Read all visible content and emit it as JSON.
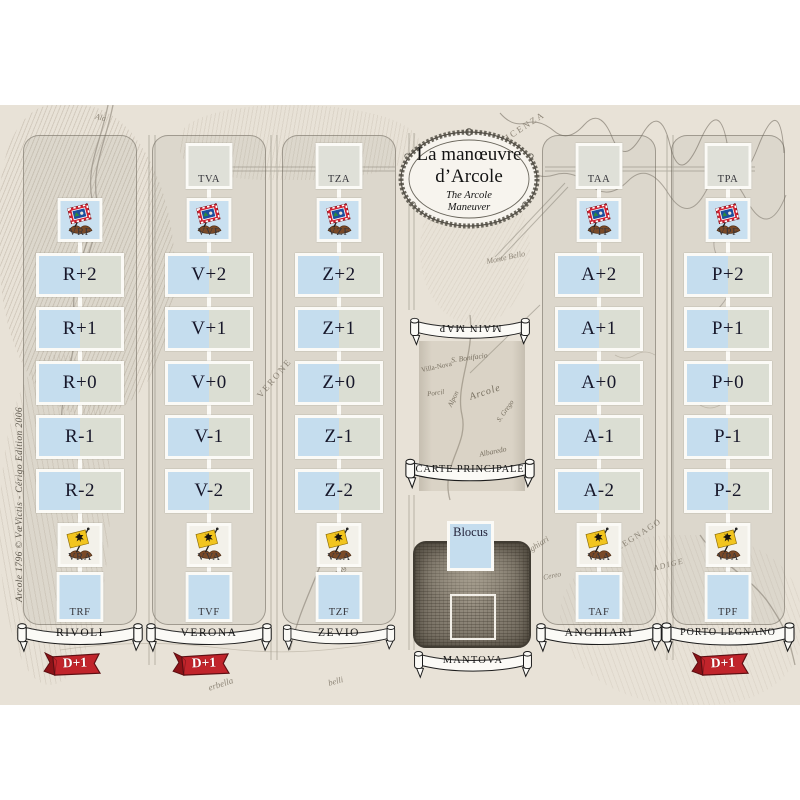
{
  "credit": "Arcole 1796 © VæVictis - Cérigo Edition 2006",
  "title": {
    "line1": "La manœuvre",
    "line2": "d’Arcole",
    "sub1": "The Arcole",
    "sub2": "Maneuver"
  },
  "center": {
    "main_map": "MAIN MAP",
    "carte_principale": "CARTE PRINCIPALE",
    "blocus": "Blocus",
    "city": "MANTOVA"
  },
  "columns": [
    {
      "city": "RIVOLI",
      "top": "",
      "french_flag": "VRF",
      "slots": [
        "R+2",
        "R+1",
        "R+0",
        "R-1",
        "R-2"
      ],
      "austrian_flag": "VRA",
      "bottom": "TRF",
      "bonus": "D+1"
    },
    {
      "city": "VERONA",
      "top": "TVA",
      "french_flag": "VVF",
      "slots": [
        "V+2",
        "V+1",
        "V+0",
        "V-1",
        "V-2"
      ],
      "austrian_flag": "VVA",
      "bottom": "TVF",
      "bonus": "D+1"
    },
    {
      "city": "ZEVIO",
      "top": "TZA",
      "french_flag": "VZF",
      "slots": [
        "Z+2",
        "Z+1",
        "Z+0",
        "Z-1",
        "Z-2"
      ],
      "austrian_flag": "VZA",
      "bottom": "TZF",
      "bonus": ""
    },
    {
      "city": "ANGHIARI",
      "top": "TAA",
      "french_flag": "VTF",
      "slots": [
        "A+2",
        "A+1",
        "A+0",
        "A-1",
        "A-2"
      ],
      "austrian_flag": "VAA",
      "bottom": "TAF",
      "bonus": ""
    },
    {
      "city": "PORTO LEGNANO",
      "top": "TPA",
      "french_flag": "VPF",
      "slots": [
        "P+2",
        "P+1",
        "P+0",
        "P-1",
        "P-2"
      ],
      "austrian_flag": "VPA",
      "bottom": "TPF",
      "bonus": "D+1"
    }
  ],
  "map_labels": [
    "VICENZA",
    "Ala",
    "Monte Bello",
    "VERONE",
    "Valleggio",
    "LEGNAGO",
    "ADIGE",
    "Anghiari",
    "Cereo",
    "erbella",
    "belli",
    "Torre"
  ],
  "scroll_labels": [
    "Villa-Nova",
    "S. Bonifacio",
    "Porcil",
    "Alpon",
    "Arcole",
    "S. Grego",
    "Albaredo",
    "Ronco"
  ],
  "colors": {
    "parchment": "#e8e2d7",
    "box_blue": "#c5ddee",
    "box_gray": "#dbded3",
    "ribbon_red": "#c1242b",
    "flag_yellow": "#f2c51f",
    "flag_blue": "#1d4f9e"
  }
}
